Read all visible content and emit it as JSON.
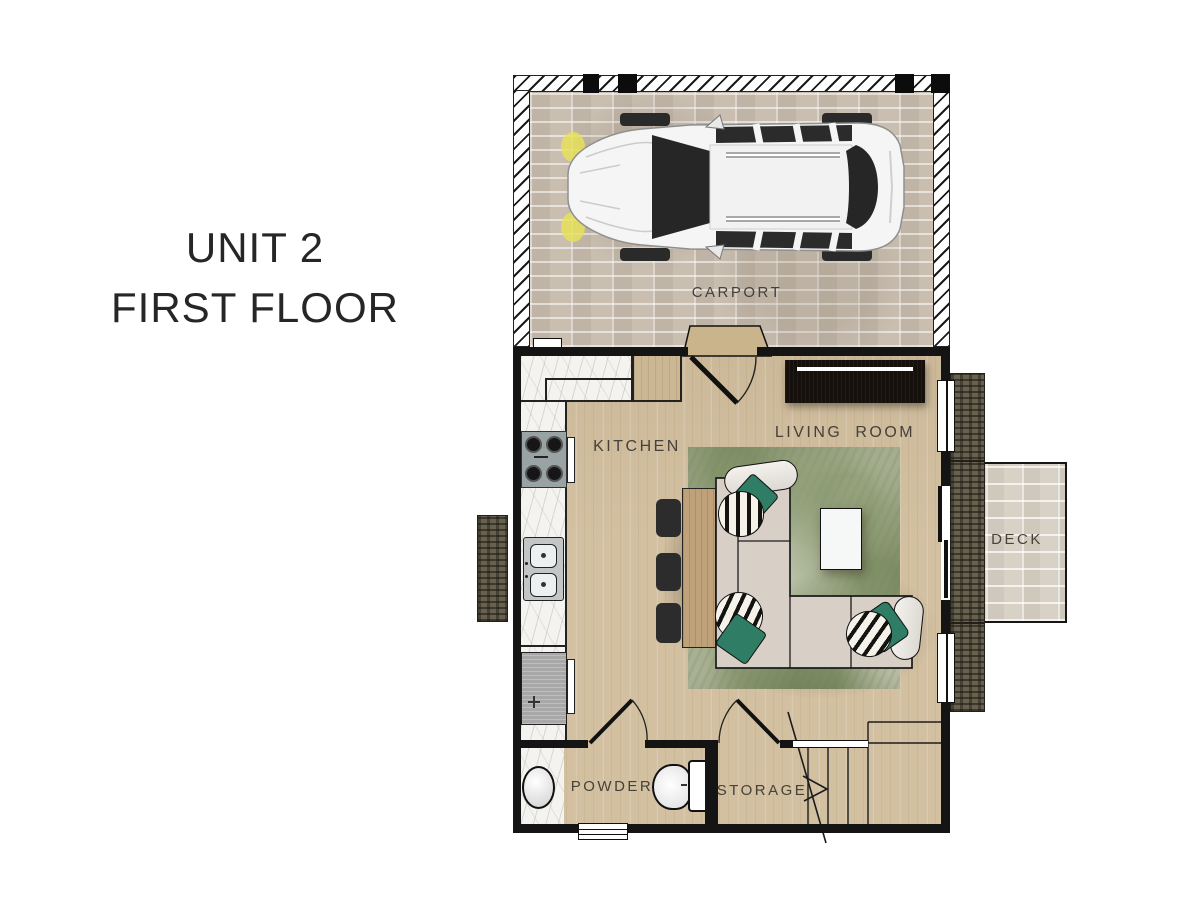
{
  "title": {
    "line1": "UNIT 2",
    "line2": "FIRST FLOOR"
  },
  "labels": {
    "carport": "CARPORT",
    "kitchen": "KITCHEN",
    "living_room": "LIVING ROOM",
    "deck": "DECK",
    "powder": "POWDER",
    "storage": "STORAGE"
  },
  "icons": {
    "car": "car-top-view-icon",
    "stove": "stove-4-burner-icon",
    "sink": "double-sink-icon",
    "toilet": "toilet-icon",
    "basin": "oval-basin-icon",
    "stairs": "stairs-up-arrow-icon"
  },
  "colors": {
    "wall": "#141414",
    "floor": "#d2c0a1",
    "brick": "#c9beb0",
    "deckbrick": "#d8d2c6",
    "planter": "#676150",
    "marble": "#f4f3ef",
    "island": "#bfa17a",
    "sofa": "#d8d0c7",
    "green": "#2e7d64",
    "tv": "#15100b",
    "label": "#46413a",
    "title": "#262626"
  }
}
